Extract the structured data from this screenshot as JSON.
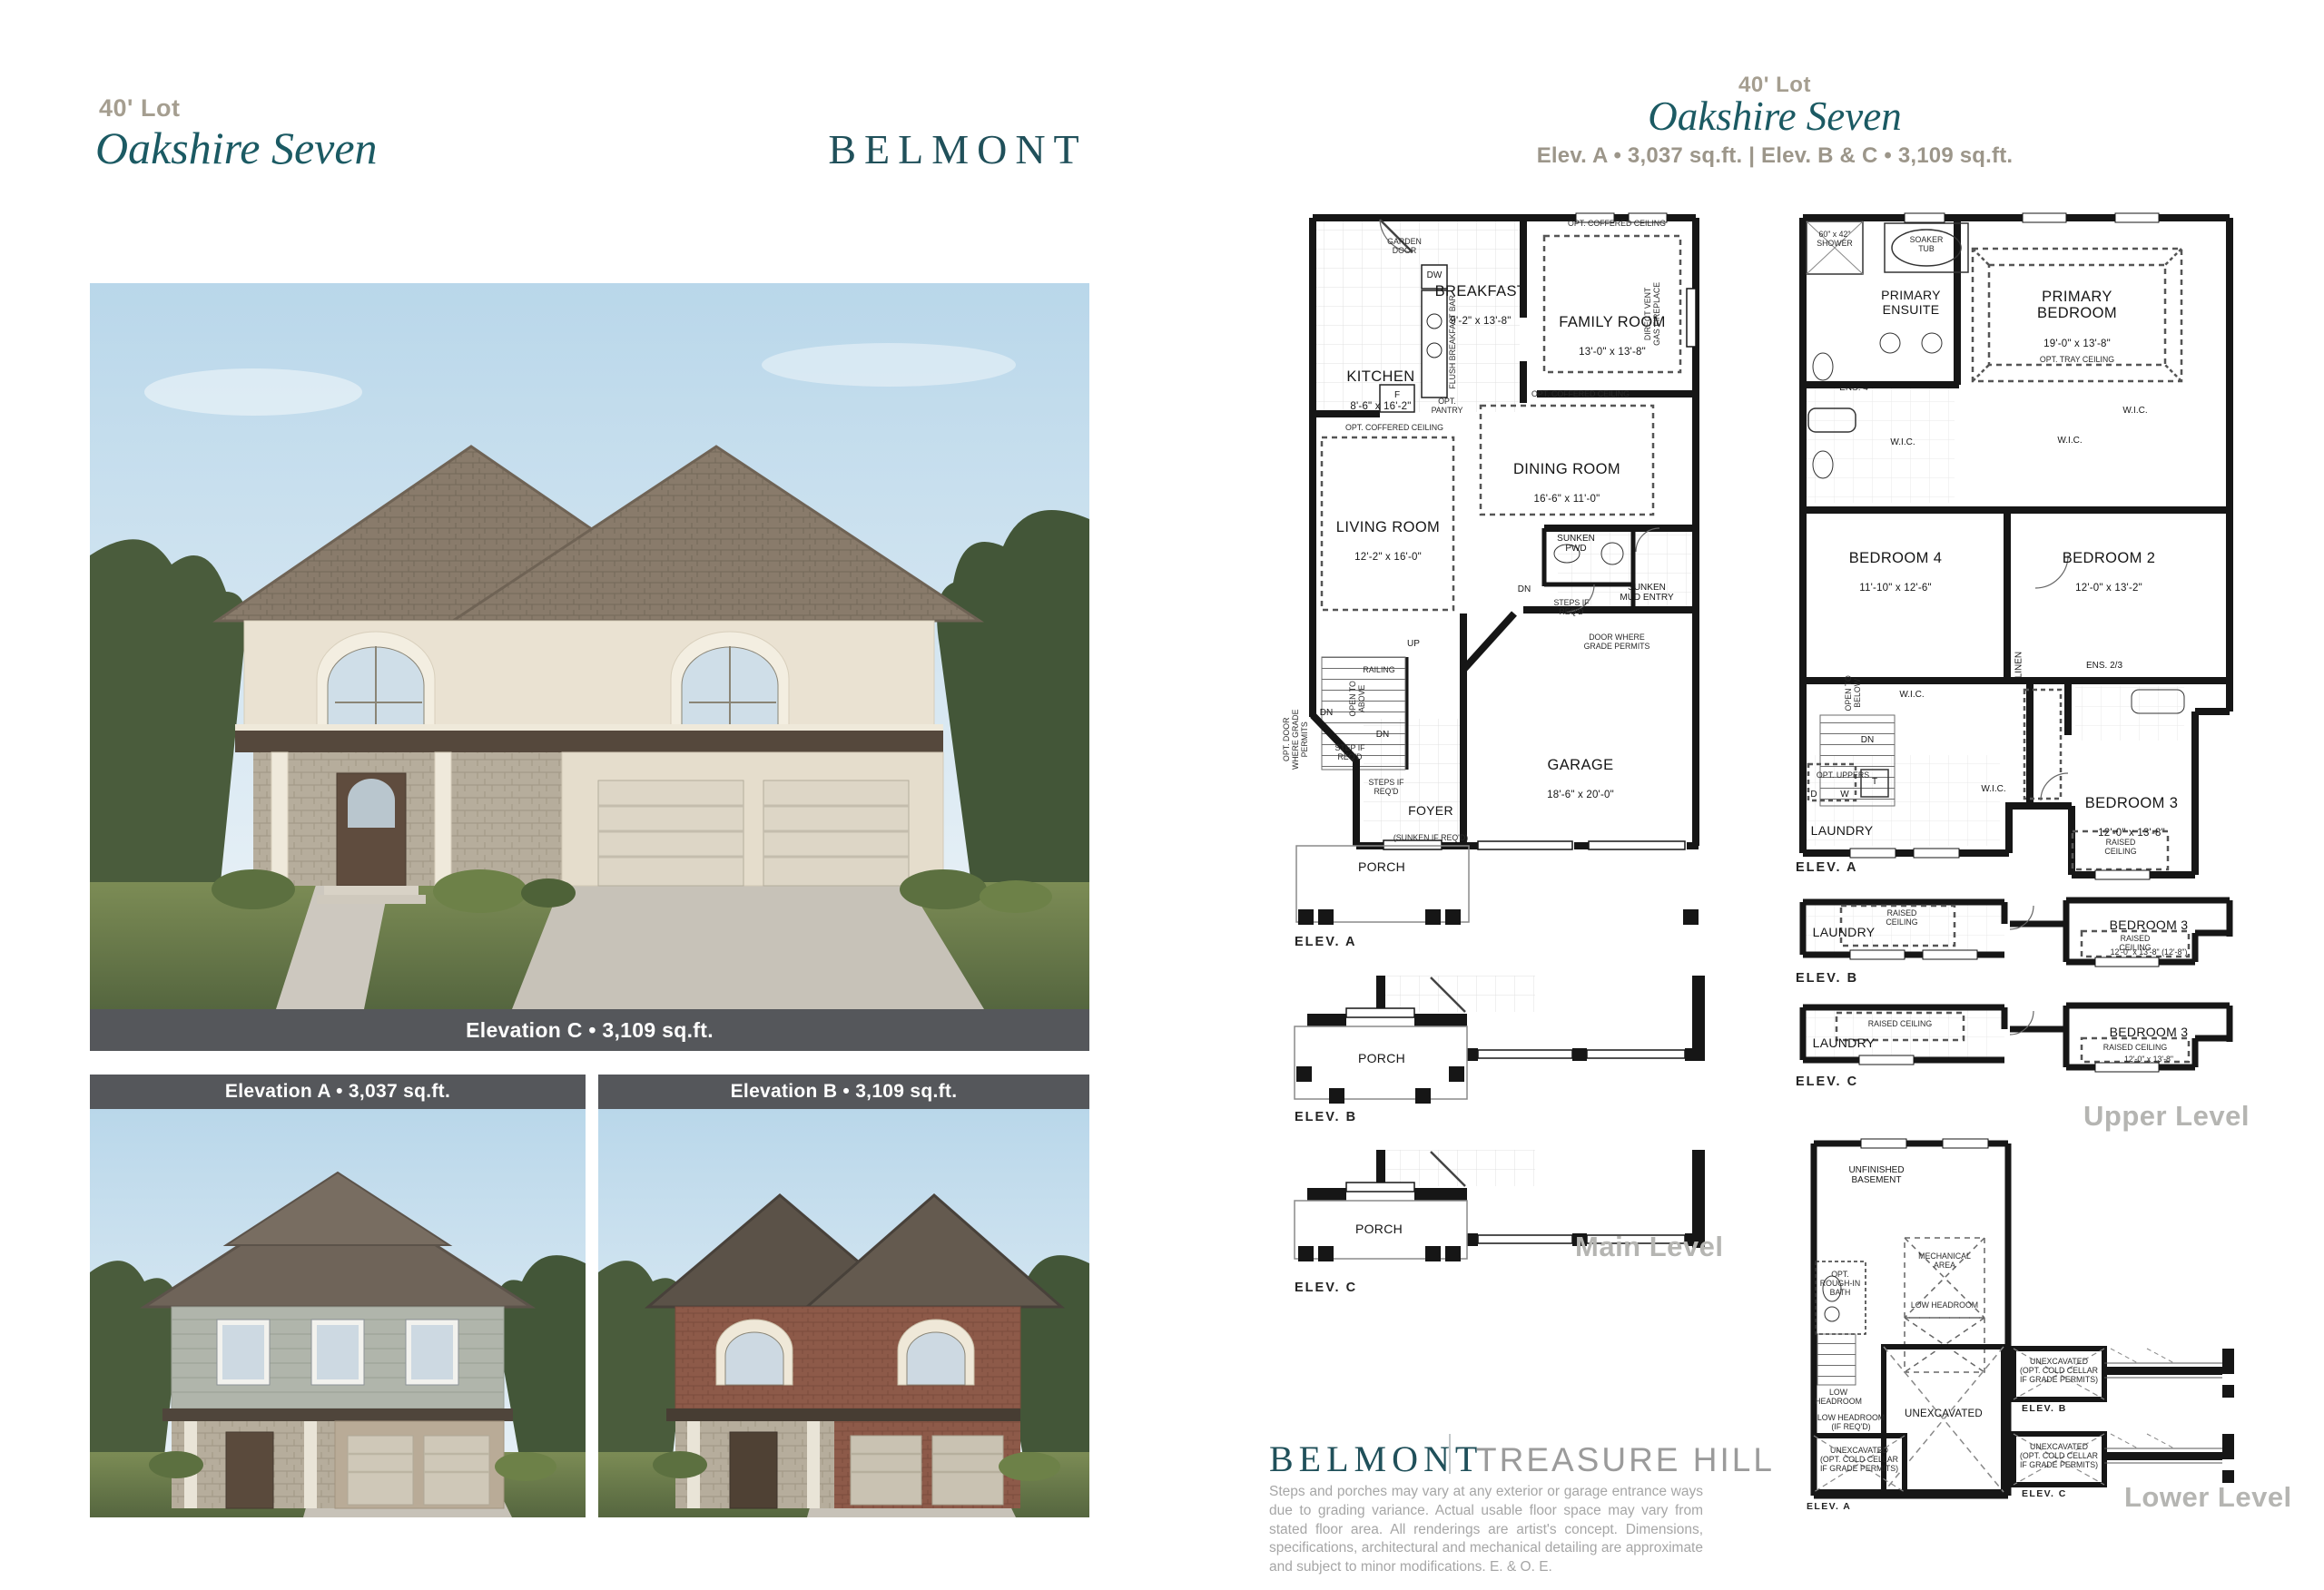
{
  "header_left": {
    "lot": "40' Lot",
    "title": "Oakshire Seven"
  },
  "brand": {
    "name": "BELMONT",
    "partner": "TREASURE HILL"
  },
  "captions": {
    "hero": "Elevation C • 3,109 sq.ft.",
    "thumb_a": "Elevation A • 3,037 sq.ft.",
    "thumb_b": "Elevation B • 3,109 sq.ft."
  },
  "header_right": {
    "lot": "40' Lot",
    "title": "Oakshire Seven",
    "specs": "Elev. A • 3,037 sq.ft.   |   Elev. B & C • 3,109 sq.ft."
  },
  "levels": {
    "main": "Main Level",
    "upper": "Upper Level",
    "lower": "Lower Level"
  },
  "elev": {
    "a": "ELEV. A",
    "b": "ELEV. B",
    "c": "ELEV. C"
  },
  "main_level": {
    "breakfast": {
      "name": "BREAKFAST",
      "dims": "9'-2\" x 13'-8\""
    },
    "family": {
      "name": "FAMILY ROOM",
      "dims": "13'-0\" x 13'-8\""
    },
    "kitchen": {
      "name": "KITCHEN",
      "dims": "8'-6\" x 16'-2\""
    },
    "dining": {
      "name": "DINING ROOM",
      "dims": "16'-6\" x 11'-0\""
    },
    "living": {
      "name": "LIVING ROOM",
      "dims": "12'-2\" x 16'-0\""
    },
    "garage": {
      "name": "GARAGE",
      "dims": "18'-6\" x 20'-0\""
    },
    "foyer": {
      "name": "FOYER",
      "note": "(SUNKEN IF REQ'D)"
    },
    "porch": "PORCH",
    "sunken_pwd": "SUNKEN\nPWD",
    "sunken_mud": "SUNKEN\nMUD ENTRY",
    "garden_door": "GARDEN\nDOOR",
    "dw": "DW",
    "flush_bar": "FLUSH BREAKFAST BAR",
    "fridge": "F",
    "opt_pantry": "OPT.\nPANTRY",
    "coffered": "OPT. COFFERED CEILING",
    "fireplace": "DIRECT VENT\nGAS FIREPLACE",
    "up": "UP",
    "dn": "DN",
    "railing": "RAILING",
    "open_above": "OPEN TO\nABOVE",
    "step_req": "STEP IF\nREQ'D",
    "steps_req": "STEPS IF\nREQ'D",
    "door_grade": "DOOR WHERE\nGRADE PERMITS",
    "opt_door_grade": "OPT. DOOR\nWHERE GRADE\nPERMITS"
  },
  "upper_level": {
    "primary_bed": {
      "name": "PRIMARY\nBEDROOM",
      "dims": "19'-0\" x 13'-8\""
    },
    "primary_ens": "PRIMARY\nENSUITE",
    "shower": "60\" x 42\"\nSHOWER",
    "soaker": "SOAKER\nTUB",
    "ens4": "ENS. 4",
    "wic": "W.I.C.",
    "bed4": {
      "name": "BEDROOM 4",
      "dims": "11'-10\" x 12'-6\""
    },
    "bed2": {
      "name": "BEDROOM 2",
      "dims": "12'-0\" x 13'-2\""
    },
    "bed3": {
      "name": "BEDROOM 3",
      "dims": "12'-0\" x 13'-8\""
    },
    "bed3_b_dims": "12'-0\" x 13'-8\" (12'-8\")",
    "linen": "LINEN",
    "ens23": "ENS. 2/3",
    "laundry": "LAUNDRY",
    "opt_tray": "OPT. TRAY CEILING",
    "open_below": "OPEN TO\nBELOW",
    "dn": "DN",
    "opt_uppers": "OPT. UPPERS",
    "d": "D",
    "w": "W",
    "t": "T",
    "raised_stack": "RAISED\nCEILING",
    "raised": "RAISED CEILING"
  },
  "lower_level": {
    "unfinished": "UNFINISHED\nBASEMENT",
    "mech": "MECHANICAL\nAREA",
    "low_head": "LOW HEADROOM",
    "low_head_req": "LOW HEADROOM\n(IF REQ'D)",
    "rough_bath": "OPT.\nROUGH-IN\nBATH",
    "unexcavated": "UNEXCAVATED",
    "cold_cellar": "UNEXCAVATED\n(OPT. COLD CELLAR\nIF GRADE PERMITS)"
  },
  "footer": {
    "disclaimer": "Steps and porches may vary at any exterior or garage entrance ways due to grading variance. Actual usable floor space may vary from stated floor area. All renderings are artist's concept. Dimensions, specifications, architectural and mechanical detailing are approximate and subject to minor modifications. E. & O. E."
  },
  "colors": {
    "teal": "#1b5a63",
    "tan": "#a59e90",
    "caption_bar": "#55575b",
    "level_gray": "#b5b5b2"
  }
}
